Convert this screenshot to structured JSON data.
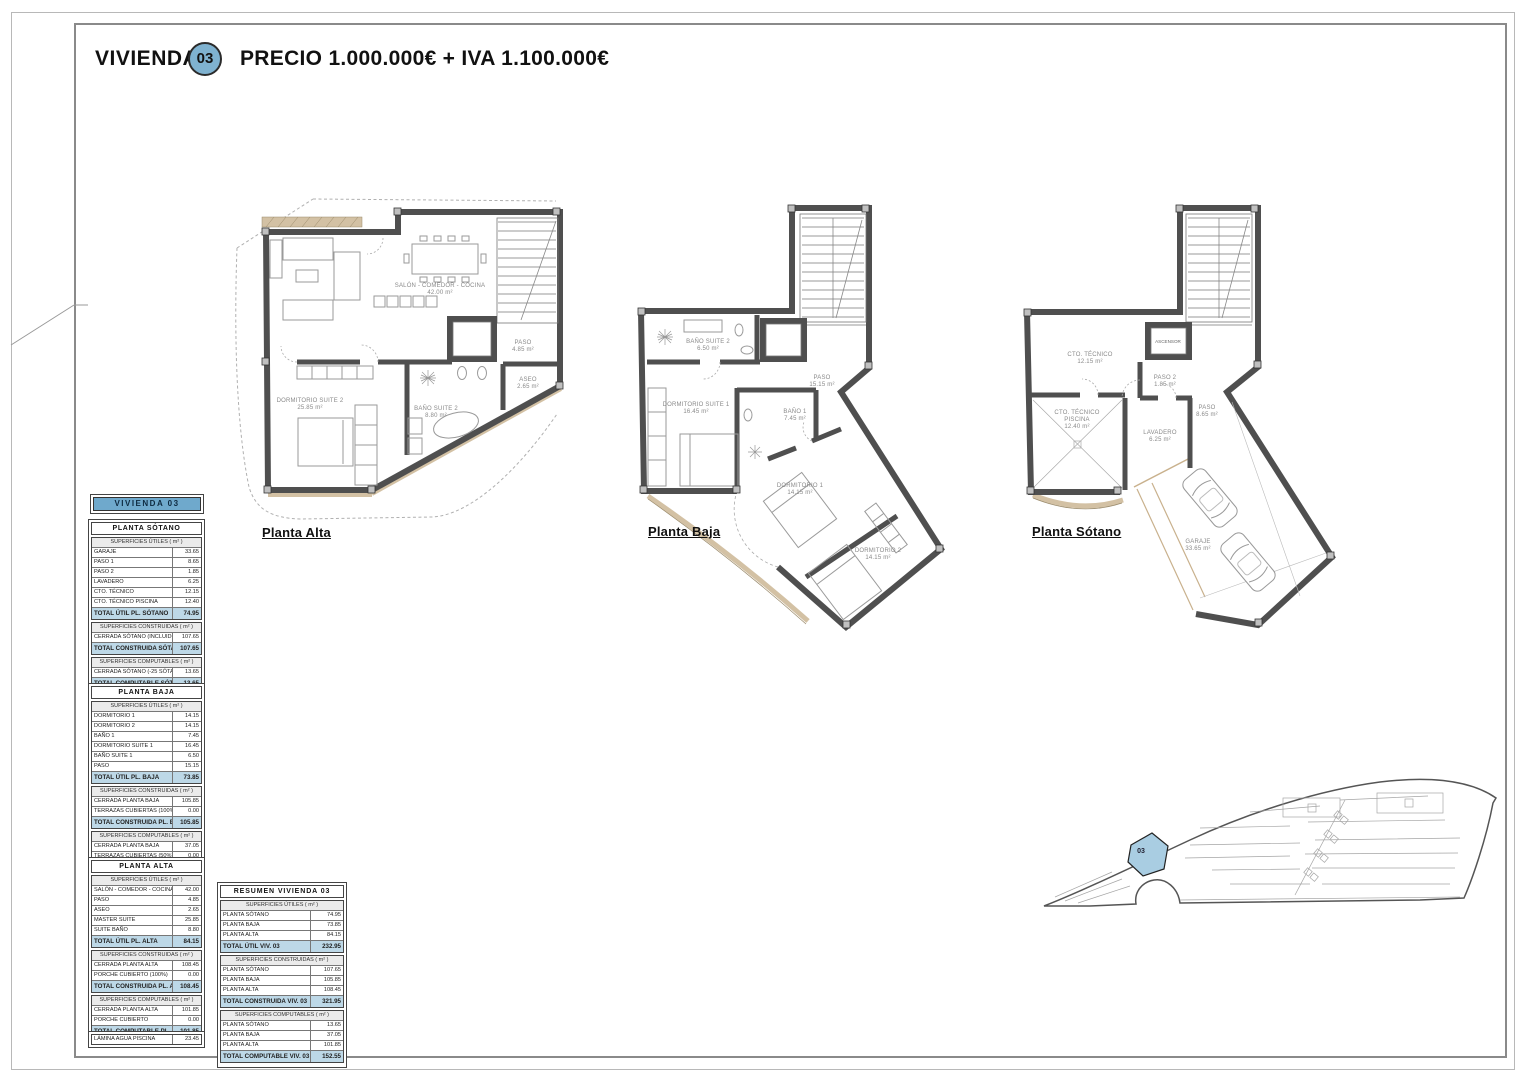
{
  "header": {
    "title": "VIVIENDA",
    "unit_badge": "03",
    "price_line": "PRECIO 1.000.000€ + IVA 1.100.000€"
  },
  "banner": {
    "label": "VIVIENDA 03"
  },
  "tables": {
    "sotano": {
      "title": "PLANTA SÓTANO",
      "blocks": [
        {
          "sub": "SUPERFICIES ÚTILES ( m² )",
          "rows": [
            {
              "label": "GARAJE",
              "value": "33.65"
            },
            {
              "label": "PASO 1",
              "value": "8.65"
            },
            {
              "label": "PASO 2",
              "value": "1.85"
            },
            {
              "label": "LAVADERO",
              "value": "6.25"
            },
            {
              "label": "CTO. TÉCNICO",
              "value": "12.15"
            },
            {
              "label": "CTO. TÉCNICO PISCINA",
              "value": "12.40"
            }
          ],
          "total": {
            "label": "TOTAL ÚTIL PL. SÓTANO",
            "value": "74.95"
          }
        },
        {
          "sub": "SUPERFICIES CONSTRUIDAS ( m² )",
          "rows": [
            {
              "label": "CERRADA SÓTANO (INCLUIDO SOT.)",
              "value": "107.65"
            }
          ],
          "total": {
            "label": "TOTAL CONSTRUIDA SÓTANO",
            "value": "107.65"
          }
        },
        {
          "sub": "SUPERFICIES COMPUTABLES ( m² )",
          "rows": [
            {
              "label": "CERRADA SÓTANO (-25 SÓTANO)",
              "value": "13.65"
            }
          ],
          "total": {
            "label": "TOTAL COMPUTABLE SÓTANO",
            "value": "13.65"
          }
        }
      ]
    },
    "baja": {
      "title": "PLANTA BAJA",
      "blocks": [
        {
          "sub": "SUPERFICIES ÚTILES ( m² )",
          "rows": [
            {
              "label": "DORMITORIO 1",
              "value": "14.15"
            },
            {
              "label": "DORMITORIO 2",
              "value": "14.15"
            },
            {
              "label": "BAÑO 1",
              "value": "7.45"
            },
            {
              "label": "DORMITORIO SUITE 1",
              "value": "16.45"
            },
            {
              "label": "BAÑO SUITE 1",
              "value": "6.50"
            },
            {
              "label": "PASO",
              "value": "15.15"
            }
          ],
          "total": {
            "label": "TOTAL ÚTIL PL. BAJA",
            "value": "73.85"
          }
        },
        {
          "sub": "SUPERFICIES CONSTRUIDAS ( m² )",
          "rows": [
            {
              "label": "CERRADA PLANTA BAJA",
              "value": "105.85"
            },
            {
              "label": "TERRAZAS CUBIERTAS (100%)",
              "value": "0.00"
            }
          ],
          "total": {
            "label": "TOTAL CONSTRUIDA PL. BAJA",
            "value": "105.85"
          }
        },
        {
          "sub": "SUPERFICIES COMPUTABLES ( m² )",
          "rows": [
            {
              "label": "CERRADA PLANTA BAJA",
              "value": "37.05"
            },
            {
              "label": "TERRAZAS CUBIERTAS (50%)",
              "value": "0.00"
            }
          ],
          "total": {
            "label": "TOTAL COMPUTABLE PL. BAJA",
            "value": "37.05"
          }
        }
      ]
    },
    "alta": {
      "title": "PLANTA ALTA",
      "blocks": [
        {
          "sub": "SUPERFICIES ÚTILES ( m² )",
          "rows": [
            {
              "label": "SALÓN - COMEDOR - COCINA",
              "value": "42.00"
            },
            {
              "label": "PASO",
              "value": "4.85"
            },
            {
              "label": "ASEO",
              "value": "2.65"
            },
            {
              "label": "MASTER SUITE",
              "value": "25.85"
            },
            {
              "label": "SUITE BAÑO",
              "value": "8.80"
            }
          ],
          "total": {
            "label": "TOTAL ÚTIL PL. ALTA",
            "value": "84.15"
          }
        },
        {
          "sub": "SUPERFICIES CONSTRUIDAS ( m² )",
          "rows": [
            {
              "label": "CERRADA PLANTA ALTA",
              "value": "108.45"
            },
            {
              "label": "PORCHE CUBIERTO (100%)",
              "value": "0.00"
            }
          ],
          "total": {
            "label": "TOTAL CONSTRUIDA PL. ALTA",
            "value": "108.45"
          }
        },
        {
          "sub": "SUPERFICIES COMPUTABLES ( m² )",
          "rows": [
            {
              "label": "CERRADA PLANTA ALTA",
              "value": "101.85"
            },
            {
              "label": "PORCHE CUBIERTO",
              "value": "0.00"
            }
          ],
          "total": {
            "label": "TOTAL COMPUTABLE PL. ALTA",
            "value": "101.85"
          }
        }
      ]
    },
    "lamina": {
      "label": "LÁMINA AGUA PISCINA",
      "value": "23.45"
    },
    "resumen": {
      "title": "RESUMEN VIVIENDA 03",
      "blocks": [
        {
          "sub": "SUPERFICIES ÚTILES ( m² )",
          "rows": [
            {
              "label": "PLANTA SÓTANO",
              "value": "74.95"
            },
            {
              "label": "PLANTA BAJA",
              "value": "73.85"
            },
            {
              "label": "PLANTA ALTA",
              "value": "84.15"
            }
          ],
          "total": {
            "label": "TOTAL ÚTIL VIV. 03",
            "value": "232.95"
          }
        },
        {
          "sub": "SUPERFICIES CONSTRUIDAS ( m² )",
          "rows": [
            {
              "label": "PLANTA SÓTANO",
              "value": "107.65"
            },
            {
              "label": "PLANTA BAJA",
              "value": "105.85"
            },
            {
              "label": "PLANTA ALTA",
              "value": "108.45"
            }
          ],
          "total": {
            "label": "TOTAL CONSTRUIDA VIV. 03",
            "value": "321.95"
          }
        },
        {
          "sub": "SUPERFICIES COMPUTABLES ( m² )",
          "rows": [
            {
              "label": "PLANTA SÓTANO",
              "value": "13.65"
            },
            {
              "label": "PLANTA BAJA",
              "value": "37.05"
            },
            {
              "label": "PLANTA ALTA",
              "value": "101.85"
            }
          ],
          "total": {
            "label": "TOTAL COMPUTABLE VIV. 03",
            "value": "152.55"
          }
        }
      ]
    }
  },
  "plans": {
    "alta": {
      "label": "Planta Alta",
      "rooms": {
        "salon": {
          "name": "SALÓN - COMEDOR - COCINA",
          "area": "42.00 m²"
        },
        "paso": {
          "name": "PASO",
          "area": "4.85 m²"
        },
        "aseo": {
          "name": "ASEO",
          "area": "2.65 m²"
        },
        "dormitorio_suite_2": {
          "name": "DORMITORIO SUITE 2",
          "area": "25.85 m²"
        },
        "bano_suite_2": {
          "name": "BAÑO SUITE 2",
          "area": "8.80 m²"
        }
      }
    },
    "baja": {
      "label": "Planta Baja",
      "rooms": {
        "bano_suite_2": {
          "name": "BAÑO SUITE 2",
          "area": "6.50 m²"
        },
        "paso": {
          "name": "PASO",
          "area": "15.15 m²"
        },
        "dormitorio_suite_1": {
          "name": "DORMITORIO SUITE 1",
          "area": "16.45 m²"
        },
        "bano_1": {
          "name": "BAÑO 1",
          "area": "7.45 m²"
        },
        "dormitorio_1": {
          "name": "DORMITORIO 1",
          "area": "14.15 m²"
        },
        "dormitorio_2": {
          "name": "DORMITORIO 2",
          "area": "14.15 m²"
        }
      }
    },
    "sotano": {
      "label": "Planta Sótano",
      "rooms": {
        "cto_tecnico": {
          "name": "CTO. TÉCNICO",
          "area": "12.15 m²"
        },
        "ascensor": {
          "name": "ASCENSOR"
        },
        "paso_2": {
          "name": "PASO 2",
          "area": "1.85 m²"
        },
        "cto_tecnico_piscina": {
          "name": "CTO. TÉCNICO",
          "name2": "PISCINA",
          "area": "12.40 m²"
        },
        "lavadero": {
          "name": "LAVADERO",
          "area": "6.25 m²"
        },
        "paso": {
          "name": "PASO",
          "area": "8.65 m²"
        },
        "garaje": {
          "name": "GARAJE",
          "area": "33.65 m²"
        }
      }
    }
  },
  "site_plan": {
    "unit_label": "03"
  },
  "colors": {
    "accent_blue": "#7fb2d0",
    "banner_blue": "#6fa9cc",
    "total_row_blue": "#bdd8e7",
    "unit_highlight": "#a9cde2",
    "wall_gray": "#4f4f4f",
    "tan": "#cbb696"
  }
}
